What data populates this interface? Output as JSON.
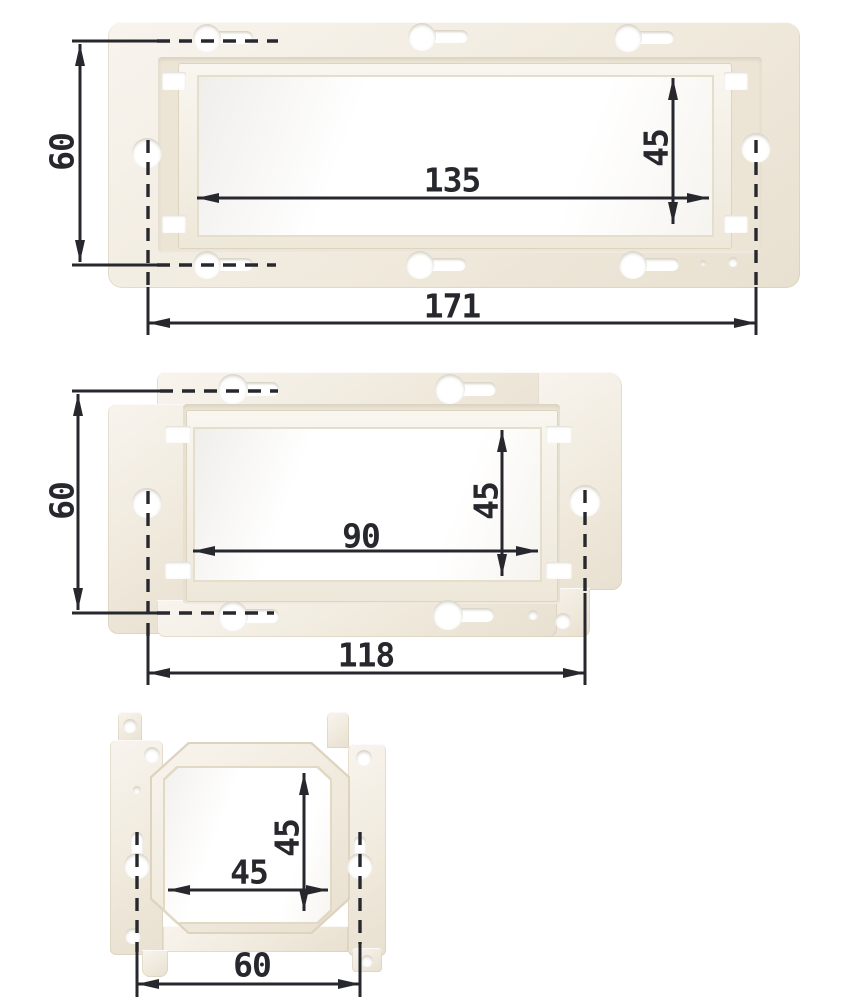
{
  "colors": {
    "background": "#ffffff",
    "dimension_ink": "#27272e",
    "plastic_highlight": "#f8f4ee",
    "plastic_base": "#efe9dc",
    "plastic_shadow": "#e6decd"
  },
  "figures": [
    {
      "id": "large-mounting-frame",
      "dims": {
        "hole_spacing_height": "60",
        "opening_width": "135",
        "opening_height": "45",
        "overall_width": "171"
      }
    },
    {
      "id": "medium-mounting-frame",
      "dims": {
        "hole_spacing_height": "60",
        "opening_width": "90",
        "opening_height": "45",
        "overall_width": "118"
      }
    },
    {
      "id": "small-mounting-bracket",
      "dims": {
        "opening_width": "45",
        "opening_height": "45",
        "overall_width": "60"
      }
    }
  ]
}
